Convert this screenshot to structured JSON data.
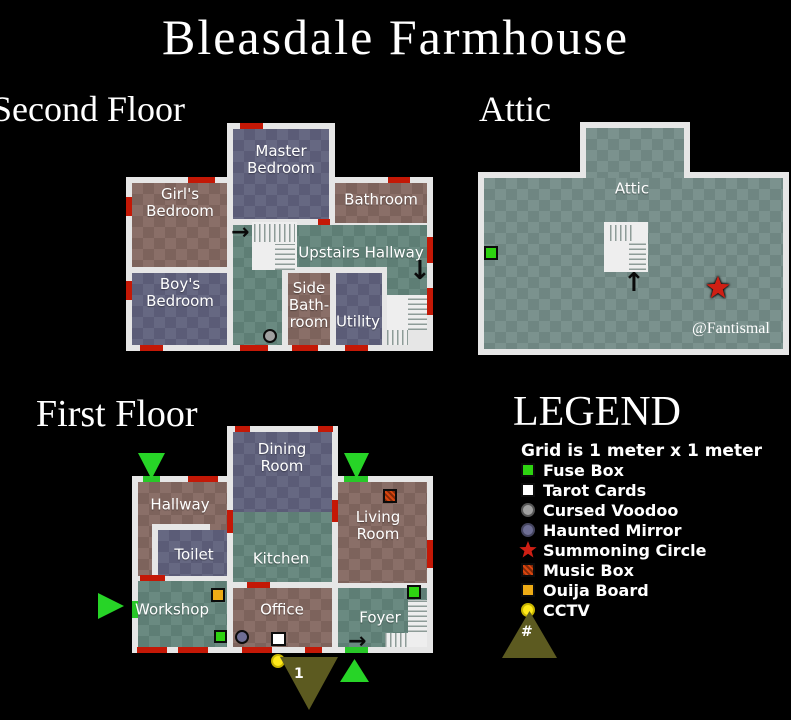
{
  "title": "Bleasdale Farmhouse",
  "sections": {
    "second_floor": "Second Floor",
    "attic": "Attic",
    "first_floor": "First Floor"
  },
  "watermark": "@Fantismal",
  "second_floor": {
    "rooms": {
      "master_bedroom": "Master\nBedroom",
      "girls_bedroom": "Girl's\nBedroom",
      "boys_bedroom": "Boy's\nBedroom",
      "bathroom": "Bathroom",
      "upstairs_hallway": "Upstairs Hallway",
      "side_bathroom": "Side\nBath-\nroom",
      "utility": "Utility"
    }
  },
  "attic": {
    "room": "Attic"
  },
  "first_floor": {
    "rooms": {
      "dining_room": "Dining\nRoom",
      "hallway": "Hallway",
      "toilet": "Toilet",
      "kitchen": "Kitchen",
      "workshop": "Workshop",
      "office": "Office",
      "living_room": "Living\nRoom",
      "foyer": "Foyer"
    }
  },
  "legend": {
    "title": "LEGEND",
    "note": "Grid is 1 meter x 1 meter",
    "items": [
      {
        "label": "Fuse Box",
        "icon": "fuse-box",
        "color": "#2ed311"
      },
      {
        "label": "Tarot Cards",
        "icon": "tarot-cards",
        "color": "#ffffff"
      },
      {
        "label": "Cursed Voodoo",
        "icon": "cursed-voodoo",
        "color": "#a0a0a0"
      },
      {
        "label": "Haunted Mirror",
        "icon": "haunted-mirror",
        "color": "#6e6e94"
      },
      {
        "label": "Summoning Circle",
        "icon": "summoning-circle",
        "color": "#cf1f14"
      },
      {
        "label": "Music Box",
        "icon": "music-box",
        "color": "#d8440e"
      },
      {
        "label": "Ouija Board",
        "icon": "ouija-board",
        "color": "#eeab15"
      },
      {
        "label": "CCTV",
        "icon": "cctv",
        "color": "#ffe81a"
      }
    ],
    "camera_symbol": "#"
  },
  "cameras": {
    "camera_1": "1"
  },
  "colors": {
    "background": "#000000",
    "wall": "#e6e6e6",
    "room_brown": "#7d635c",
    "room_blue": "#5b5c77",
    "room_green": "#5e7e75",
    "attic_teal": "#6f8682",
    "door_red": "#c41806",
    "door_green": "#28c828",
    "entry_triangle": "#27d427",
    "camera_triangle": "#5c5a20"
  }
}
